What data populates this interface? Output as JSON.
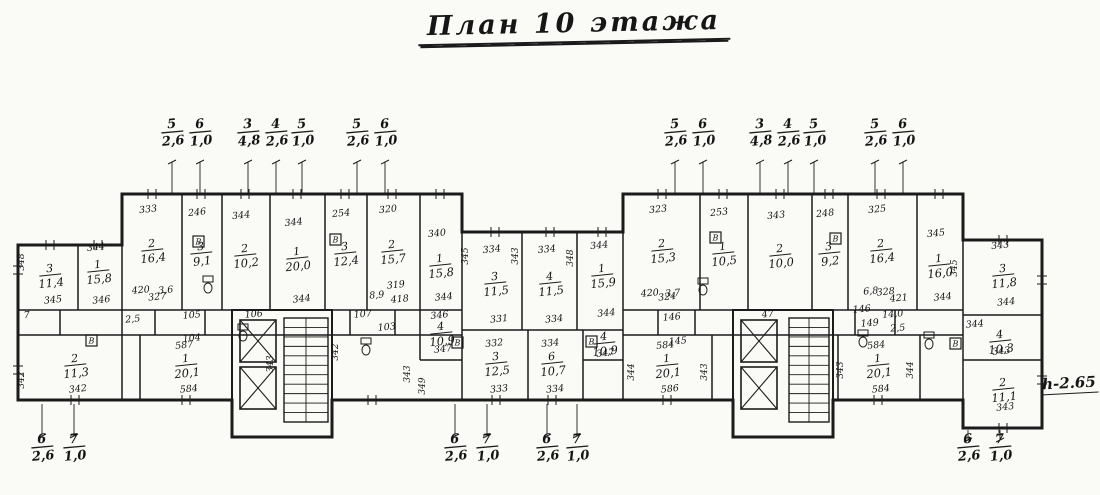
{
  "title": "План 10 этажа",
  "height_note": "h-2.65",
  "dims": {
    "top": [
      {
        "x": 172,
        "y": 128,
        "num": "5",
        "den": "2,6"
      },
      {
        "x": 200,
        "y": 128,
        "num": "6",
        "den": "1,0"
      },
      {
        "x": 248,
        "y": 128,
        "num": "3",
        "den": "4,8"
      },
      {
        "x": 276,
        "y": 128,
        "num": "4",
        "den": "2,6"
      },
      {
        "x": 302,
        "y": 128,
        "num": "5",
        "den": "1,0"
      },
      {
        "x": 357,
        "y": 128,
        "num": "5",
        "den": "2,6"
      },
      {
        "x": 385,
        "y": 128,
        "num": "6",
        "den": "1,0"
      },
      {
        "x": 675,
        "y": 128,
        "num": "5",
        "den": "2,6"
      },
      {
        "x": 703,
        "y": 128,
        "num": "6",
        "den": "1,0"
      },
      {
        "x": 760,
        "y": 128,
        "num": "3",
        "den": "4,8"
      },
      {
        "x": 788,
        "y": 128,
        "num": "4",
        "den": "2,6"
      },
      {
        "x": 814,
        "y": 128,
        "num": "5",
        "den": "1,0"
      },
      {
        "x": 875,
        "y": 128,
        "num": "5",
        "den": "2,6"
      },
      {
        "x": 903,
        "y": 128,
        "num": "6",
        "den": "1,0"
      }
    ],
    "bottom": [
      {
        "x": 42,
        "y": 443,
        "num": "6",
        "den": "2,6"
      },
      {
        "x": 74,
        "y": 443,
        "num": "7",
        "den": "1,0"
      },
      {
        "x": 455,
        "y": 443,
        "num": "6",
        "den": "2,6"
      },
      {
        "x": 487,
        "y": 443,
        "num": "7",
        "den": "1,0"
      },
      {
        "x": 547,
        "y": 443,
        "num": "6",
        "den": "2,6"
      },
      {
        "x": 577,
        "y": 443,
        "num": "7",
        "den": "1,0"
      },
      {
        "x": 968,
        "y": 443,
        "num": "6",
        "den": "2,6"
      },
      {
        "x": 1000,
        "y": 443,
        "num": "7",
        "den": "1,0"
      }
    ]
  },
  "plan": {
    "outline": "18,245 122,245 122,194 462,194 462,232 623,232 623,194 963,194 963,240 1042,240 1042,428 963,428 963,400 833,400 833,437 733,437 733,400 332,400 332,437 232,437 232,400 18,400",
    "walls": [
      [
        122,
        245,
        122,
        400
      ],
      [
        182,
        194,
        182,
        310
      ],
      [
        222,
        194,
        222,
        310
      ],
      [
        270,
        194,
        270,
        310
      ],
      [
        325,
        194,
        325,
        310
      ],
      [
        367,
        194,
        367,
        310
      ],
      [
        420,
        194,
        420,
        310
      ],
      [
        462,
        194,
        462,
        400
      ],
      [
        623,
        194,
        623,
        400
      ],
      [
        18,
        310,
        462,
        310
      ],
      [
        18,
        335,
        462,
        335
      ],
      [
        78,
        245,
        78,
        310
      ],
      [
        140,
        335,
        140,
        400
      ],
      [
        155,
        310,
        155,
        335
      ],
      [
        205,
        310,
        205,
        335
      ],
      [
        350,
        310,
        350,
        335
      ],
      [
        395,
        310,
        395,
        335
      ],
      [
        60,
        310,
        60,
        335
      ],
      [
        522,
        232,
        522,
        330
      ],
      [
        577,
        232,
        577,
        330
      ],
      [
        462,
        330,
        623,
        330
      ],
      [
        528,
        330,
        528,
        400
      ],
      [
        583,
        330,
        583,
        400
      ],
      [
        700,
        194,
        700,
        310
      ],
      [
        748,
        194,
        748,
        310
      ],
      [
        812,
        194,
        812,
        310
      ],
      [
        848,
        194,
        848,
        310
      ],
      [
        917,
        194,
        917,
        310
      ],
      [
        963,
        194,
        963,
        400
      ],
      [
        623,
        310,
        963,
        310
      ],
      [
        623,
        335,
        963,
        335
      ],
      [
        658,
        310,
        658,
        335
      ],
      [
        695,
        310,
        695,
        335
      ],
      [
        855,
        310,
        855,
        335
      ],
      [
        895,
        310,
        895,
        335
      ],
      [
        712,
        335,
        712,
        400
      ],
      [
        838,
        335,
        838,
        400
      ],
      [
        920,
        335,
        920,
        400
      ],
      [
        963,
        315,
        1042,
        315
      ],
      [
        963,
        360,
        1042,
        360
      ],
      [
        420,
        310,
        420,
        360
      ],
      [
        420,
        360,
        462,
        360
      ],
      [
        583,
        360,
        623,
        360
      ]
    ],
    "cores": [
      {
        "x": 232,
        "y": 310,
        "w": 100,
        "h": 127,
        "elev": [
          [
            240,
            320,
            36,
            42
          ],
          [
            240,
            367,
            36,
            42
          ]
        ],
        "stair": [
          284,
          318,
          44,
          104
        ]
      },
      {
        "x": 733,
        "y": 310,
        "w": 100,
        "h": 127,
        "elev": [
          [
            741,
            320,
            36,
            42
          ],
          [
            741,
            367,
            36,
            42
          ]
        ],
        "stair": [
          789,
          318,
          40,
          104
        ]
      }
    ],
    "rooms": [
      {
        "x": 152,
        "y": 247,
        "top": "333",
        "ty": 212,
        "num": "2",
        "area": "16,4",
        "sub": "327",
        "sy": 300
      },
      {
        "x": 201,
        "y": 250,
        "top": "246",
        "ty": 215,
        "num": "3",
        "area": "9,1"
      },
      {
        "x": 245,
        "y": 252,
        "top": "344",
        "ty": 218,
        "num": "2",
        "area": "10,2"
      },
      {
        "x": 297,
        "y": 255,
        "top": "344",
        "ty": 225,
        "num": "1",
        "area": "20,0",
        "sub": "344",
        "sy": 302
      },
      {
        "x": 345,
        "y": 250,
        "top": "254",
        "ty": 216,
        "num": "3",
        "area": "12,4"
      },
      {
        "x": 392,
        "y": 248,
        "top": "320",
        "ty": 212,
        "num": "2",
        "area": "15,7",
        "sub": "319",
        "sy": 288
      },
      {
        "x": 440,
        "y": 262,
        "top": "340",
        "ty": 236,
        "num": "1",
        "area": "15,8",
        "sub": "344",
        "sy": 300
      },
      {
        "x": 50,
        "y": 272,
        "num": "3",
        "area": "11,4",
        "sub": "345",
        "sy": 303
      },
      {
        "x": 98,
        "y": 268,
        "top": "344",
        "ty": 250,
        "num": "1",
        "area": "15,8",
        "sub": "346",
        "sy": 303
      },
      {
        "x": 495,
        "y": 280,
        "top": "334",
        "ty": 252,
        "num": "3",
        "area": "11,5",
        "sub": "331",
        "sy": 322
      },
      {
        "x": 550,
        "y": 280,
        "top": "334",
        "ty": 252,
        "num": "4",
        "area": "11,5",
        "sub": "334",
        "sy": 322
      },
      {
        "x": 602,
        "y": 272,
        "top": "344",
        "ty": 248,
        "num": "1",
        "area": "15,9",
        "sub": "344",
        "sy": 316
      },
      {
        "x": 662,
        "y": 247,
        "top": "323",
        "ty": 212,
        "num": "2",
        "area": "15,3",
        "sub": "324",
        "sy": 300
      },
      {
        "x": 723,
        "y": 250,
        "top": "253",
        "ty": 215,
        "num": "1",
        "area": "10,5"
      },
      {
        "x": 780,
        "y": 252,
        "top": "343",
        "ty": 218,
        "num": "2",
        "area": "10,0"
      },
      {
        "x": 829,
        "y": 250,
        "top": "248",
        "ty": 216,
        "num": "3",
        "area": "9,2"
      },
      {
        "x": 881,
        "y": 247,
        "top": "325",
        "ty": 212,
        "num": "2",
        "area": "16,4",
        "sub": "328",
        "sy": 295
      },
      {
        "x": 939,
        "y": 262,
        "top": "345",
        "ty": 236,
        "num": "1",
        "area": "16,0",
        "sub": "344",
        "sy": 300
      },
      {
        "x": 1003,
        "y": 272,
        "top": "343",
        "ty": 248,
        "num": "3",
        "area": "11,8",
        "sub": "344",
        "sy": 305
      },
      {
        "x": 1000,
        "y": 338,
        "num": "4",
        "area": "10,3",
        "sub": "343",
        "sy": 354
      },
      {
        "x": 1003,
        "y": 386,
        "num": "2",
        "area": "11,1",
        "sub": "343",
        "sy": 410
      },
      {
        "x": 75,
        "y": 362,
        "num": "2",
        "area": "11,3",
        "sub": "342",
        "sy": 392
      },
      {
        "x": 186,
        "y": 362,
        "top": "587",
        "ty": 348,
        "num": "1",
        "area": "20,1",
        "sub": "584",
        "sy": 392
      },
      {
        "x": 441,
        "y": 330,
        "top": "346",
        "ty": 318,
        "num": "4",
        "area": "10,9",
        "sub": "347",
        "sy": 352
      },
      {
        "x": 496,
        "y": 360,
        "top": "332",
        "ty": 346,
        "num": "3",
        "area": "12,5",
        "sub": "333",
        "sy": 392
      },
      {
        "x": 552,
        "y": 360,
        "top": "334",
        "ty": 346,
        "num": "6",
        "area": "10,7",
        "sub": "334",
        "sy": 392
      },
      {
        "x": 604,
        "y": 340,
        "num": "4",
        "area": "10,9",
        "sub": "347",
        "sy": 356
      },
      {
        "x": 667,
        "y": 362,
        "top": "584",
        "ty": 348,
        "num": "1",
        "area": "20,1",
        "sub": "586",
        "sy": 392
      },
      {
        "x": 878,
        "y": 362,
        "top": "584",
        "ty": 348,
        "num": "1",
        "area": "20,1",
        "sub": "584",
        "sy": 392
      }
    ],
    "slabels": [
      {
        "x": 192,
        "y": 318,
        "t": "105"
      },
      {
        "x": 192,
        "y": 341,
        "t": "104"
      },
      {
        "x": 254,
        "y": 317,
        "t": "106"
      },
      {
        "x": 363,
        "y": 317,
        "t": "107"
      },
      {
        "x": 387,
        "y": 330,
        "t": "103"
      },
      {
        "x": 141,
        "y": 293,
        "t": "420"
      },
      {
        "x": 166,
        "y": 293,
        "t": "3,6"
      },
      {
        "x": 377,
        "y": 298,
        "t": "8,9"
      },
      {
        "x": 400,
        "y": 302,
        "t": "418"
      },
      {
        "x": 650,
        "y": 296,
        "t": "420"
      },
      {
        "x": 673,
        "y": 296,
        "t": "3,7"
      },
      {
        "x": 871,
        "y": 294,
        "t": "6,8"
      },
      {
        "x": 899,
        "y": 301,
        "t": "421"
      },
      {
        "x": 672,
        "y": 320,
        "t": "146"
      },
      {
        "x": 678,
        "y": 344,
        "t": "145"
      },
      {
        "x": 862,
        "y": 312,
        "t": "146"
      },
      {
        "x": 870,
        "y": 326,
        "t": "149"
      },
      {
        "x": 893,
        "y": 317,
        "t": "14,0"
      },
      {
        "x": 898,
        "y": 331,
        "t": "2,5"
      },
      {
        "x": 133,
        "y": 322,
        "t": "2,5"
      },
      {
        "x": 768,
        "y": 317,
        "t": "47"
      },
      {
        "x": 27,
        "y": 318,
        "t": "7"
      },
      {
        "x": 975,
        "y": 327,
        "t": "344"
      }
    ],
    "vlabels": [
      {
        "x": 24,
        "y": 262,
        "t": "348"
      },
      {
        "x": 24,
        "y": 380,
        "t": "342"
      },
      {
        "x": 338,
        "y": 352,
        "t": "342"
      },
      {
        "x": 273,
        "y": 364,
        "t": "343"
      },
      {
        "x": 410,
        "y": 374,
        "t": "343"
      },
      {
        "x": 425,
        "y": 386,
        "t": "349"
      },
      {
        "x": 468,
        "y": 256,
        "t": "345"
      },
      {
        "x": 518,
        "y": 256,
        "t": "343"
      },
      {
        "x": 573,
        "y": 258,
        "t": "348"
      },
      {
        "x": 634,
        "y": 372,
        "t": "344"
      },
      {
        "x": 707,
        "y": 372,
        "t": "343"
      },
      {
        "x": 843,
        "y": 370,
        "t": "343"
      },
      {
        "x": 913,
        "y": 370,
        "t": "344"
      },
      {
        "x": 957,
        "y": 268,
        "t": "345"
      }
    ],
    "bath_letter": "В",
    "bicons": [
      {
        "x": 193,
        "y": 236
      },
      {
        "x": 330,
        "y": 234
      },
      {
        "x": 710,
        "y": 232
      },
      {
        "x": 830,
        "y": 233
      },
      {
        "x": 452,
        "y": 337
      },
      {
        "x": 586,
        "y": 336
      },
      {
        "x": 950,
        "y": 338
      },
      {
        "x": 86,
        "y": 335
      }
    ],
    "fixtures": [
      {
        "x": 203,
        "y": 276
      },
      {
        "x": 238,
        "y": 324
      },
      {
        "x": 698,
        "y": 278
      },
      {
        "x": 858,
        "y": 330
      },
      {
        "x": 924,
        "y": 332
      },
      {
        "x": 361,
        "y": 338
      }
    ],
    "leaders_top": {
      "y1": 162,
      "y2": 194,
      "xs": [
        172,
        200,
        248,
        276,
        302,
        357,
        385,
        675,
        703,
        760,
        788,
        814,
        875,
        903
      ]
    },
    "leaders_bottom": [
      {
        "x": 42,
        "y1": 404,
        "y2": 436
      },
      {
        "x": 74,
        "y1": 404,
        "y2": 436
      },
      {
        "x": 455,
        "y1": 404,
        "y2": 436
      },
      {
        "x": 487,
        "y1": 404,
        "y2": 436
      },
      {
        "x": 547,
        "y1": 404,
        "y2": 436
      },
      {
        "x": 577,
        "y1": 404,
        "y2": 436
      },
      {
        "x": 968,
        "y1": 430,
        "y2": 440
      },
      {
        "x": 1000,
        "y1": 430,
        "y2": 440
      }
    ],
    "wticks": [
      {
        "x": 152,
        "y": 194,
        "o": "h"
      },
      {
        "x": 201,
        "y": 194,
        "o": "h"
      },
      {
        "x": 245,
        "y": 194,
        "o": "h"
      },
      {
        "x": 297,
        "y": 194,
        "o": "h"
      },
      {
        "x": 345,
        "y": 194,
        "o": "h"
      },
      {
        "x": 392,
        "y": 194,
        "o": "h"
      },
      {
        "x": 440,
        "y": 194,
        "o": "h"
      },
      {
        "x": 662,
        "y": 194,
        "o": "h"
      },
      {
        "x": 723,
        "y": 194,
        "o": "h"
      },
      {
        "x": 780,
        "y": 194,
        "o": "h"
      },
      {
        "x": 829,
        "y": 194,
        "o": "h"
      },
      {
        "x": 881,
        "y": 194,
        "o": "h"
      },
      {
        "x": 939,
        "y": 194,
        "o": "h"
      },
      {
        "x": 495,
        "y": 232,
        "o": "h"
      },
      {
        "x": 550,
        "y": 232,
        "o": "h"
      },
      {
        "x": 602,
        "y": 232,
        "o": "h"
      },
      {
        "x": 50,
        "y": 245,
        "o": "h"
      },
      {
        "x": 98,
        "y": 245,
        "o": "h"
      },
      {
        "x": 1003,
        "y": 240,
        "o": "h"
      },
      {
        "x": 75,
        "y": 400,
        "o": "h"
      },
      {
        "x": 186,
        "y": 400,
        "o": "h"
      },
      {
        "x": 372,
        "y": 400,
        "o": "h"
      },
      {
        "x": 496,
        "y": 400,
        "o": "h"
      },
      {
        "x": 552,
        "y": 400,
        "o": "h"
      },
      {
        "x": 667,
        "y": 400,
        "o": "h"
      },
      {
        "x": 878,
        "y": 400,
        "o": "h"
      },
      {
        "x": 1003,
        "y": 428,
        "o": "h"
      },
      {
        "x": 18,
        "y": 270,
        "o": "v"
      },
      {
        "x": 18,
        "y": 370,
        "o": "v"
      },
      {
        "x": 1042,
        "y": 280,
        "o": "v"
      },
      {
        "x": 1042,
        "y": 380,
        "o": "v"
      }
    ]
  }
}
